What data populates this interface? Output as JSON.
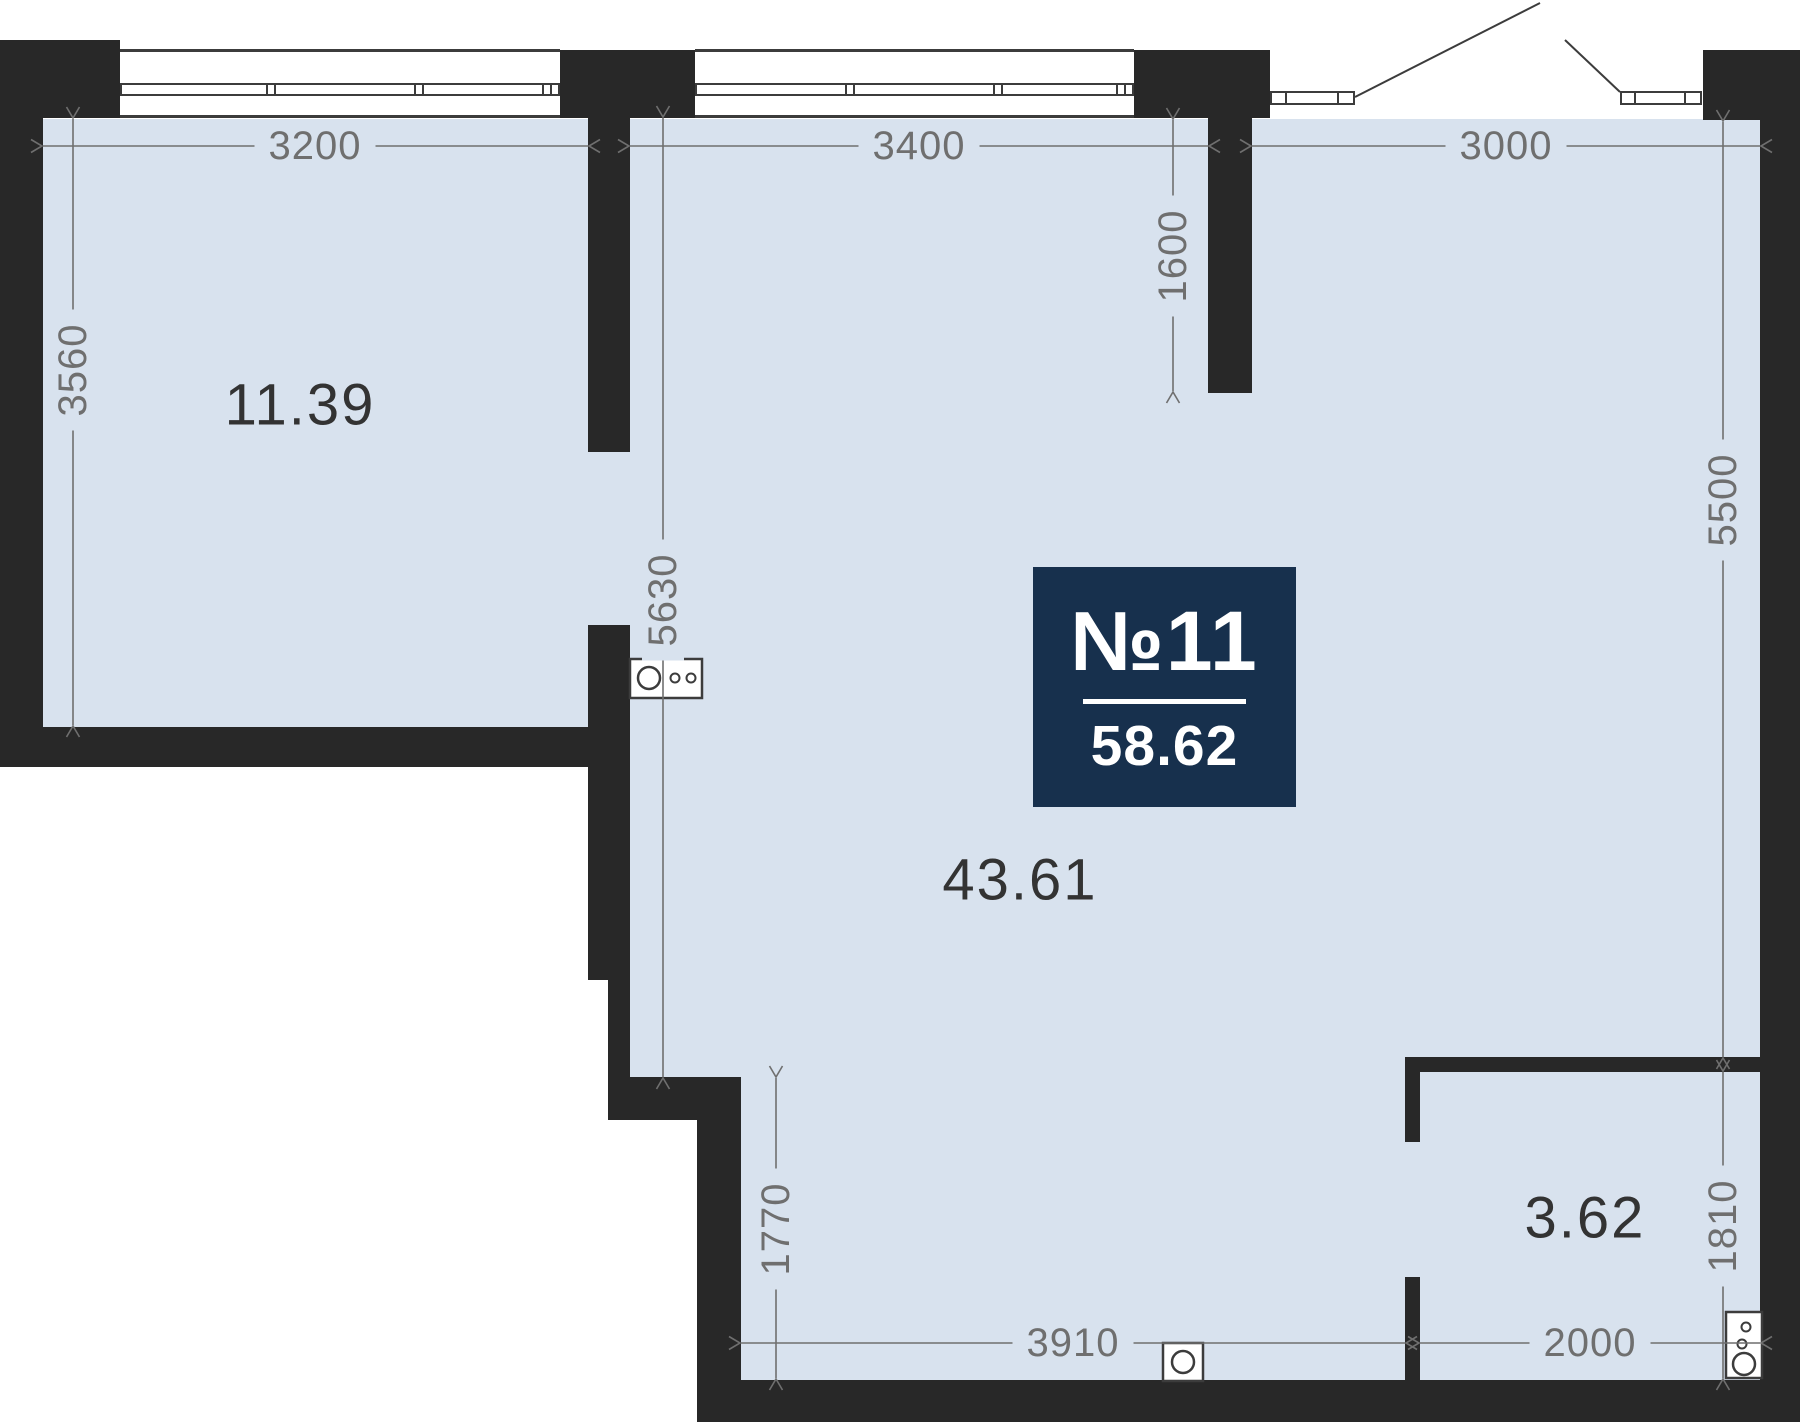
{
  "plan_title": "Floor plan unit 11",
  "badge": {
    "number": "№11",
    "total_area": "58.62"
  },
  "rooms": {
    "top_left": {
      "area": "11.39"
    },
    "main": {
      "area": "43.61"
    },
    "bottom_right": {
      "area": "3.62"
    }
  },
  "dimensions": {
    "top_left_width": "3200",
    "top_center_width": "3400",
    "top_right_width": "3000",
    "left_height": "3560",
    "center_height": "5630",
    "entry_stub_height": "1600",
    "right_height": "5500",
    "bottom_left_height": "1770",
    "bottom_center_width": "3910",
    "bottom_right_width": "2000",
    "right_bottom_height": "1810"
  },
  "colors": {
    "wall": "#282828",
    "floor": "#d8e2ee",
    "badge": "#17304d",
    "dim": "#6f6f6f",
    "ink": "#333333",
    "frame": "#3c3c3c"
  }
}
